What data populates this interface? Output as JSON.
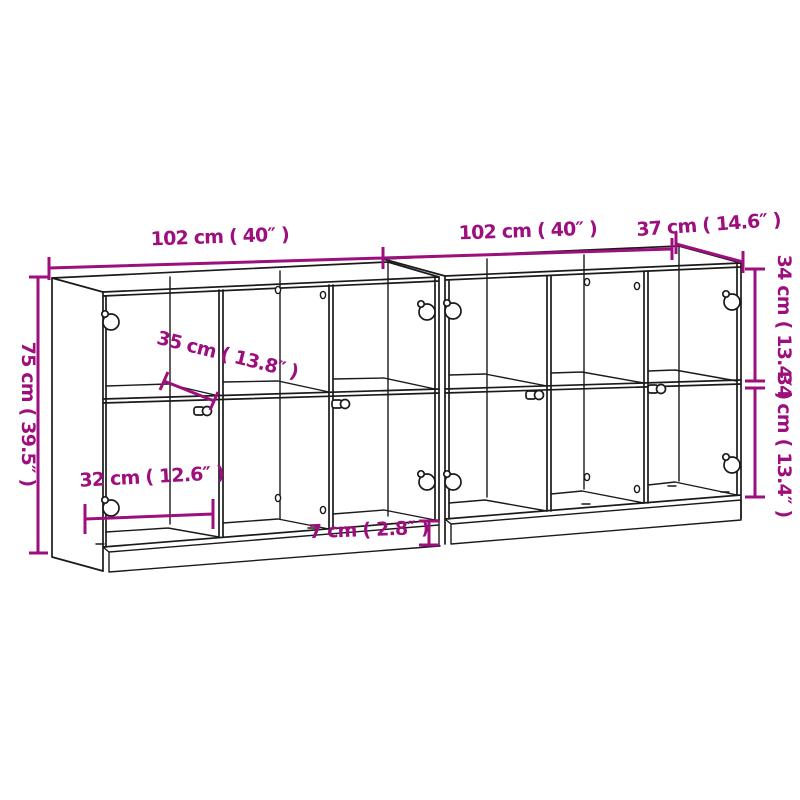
{
  "diagram": {
    "subject": "bookcase-with-doors-dimension-drawing",
    "colors": {
      "dimension": "#9C0F7D",
      "line": "#1A1A1A",
      "background": "#FFFFFF"
    },
    "dimensions": {
      "left_unit_width": "102 cm ( 40″ )",
      "right_unit_width": "102 cm ( 40″ )",
      "depth": "37 cm ( 14.6″ )",
      "overall_height": "75 cm ( 39.5″ )",
      "upper_section_height": "34 cm ( 13.4″ )",
      "lower_section_height": "34 cm ( 13.4″ )",
      "shelf_depth": "35 cm ( 13.8″ )",
      "inner_compartment_width": "32 cm ( 12.6″ )",
      "plinth_height": "7 cm ( 2.8″ )"
    }
  }
}
